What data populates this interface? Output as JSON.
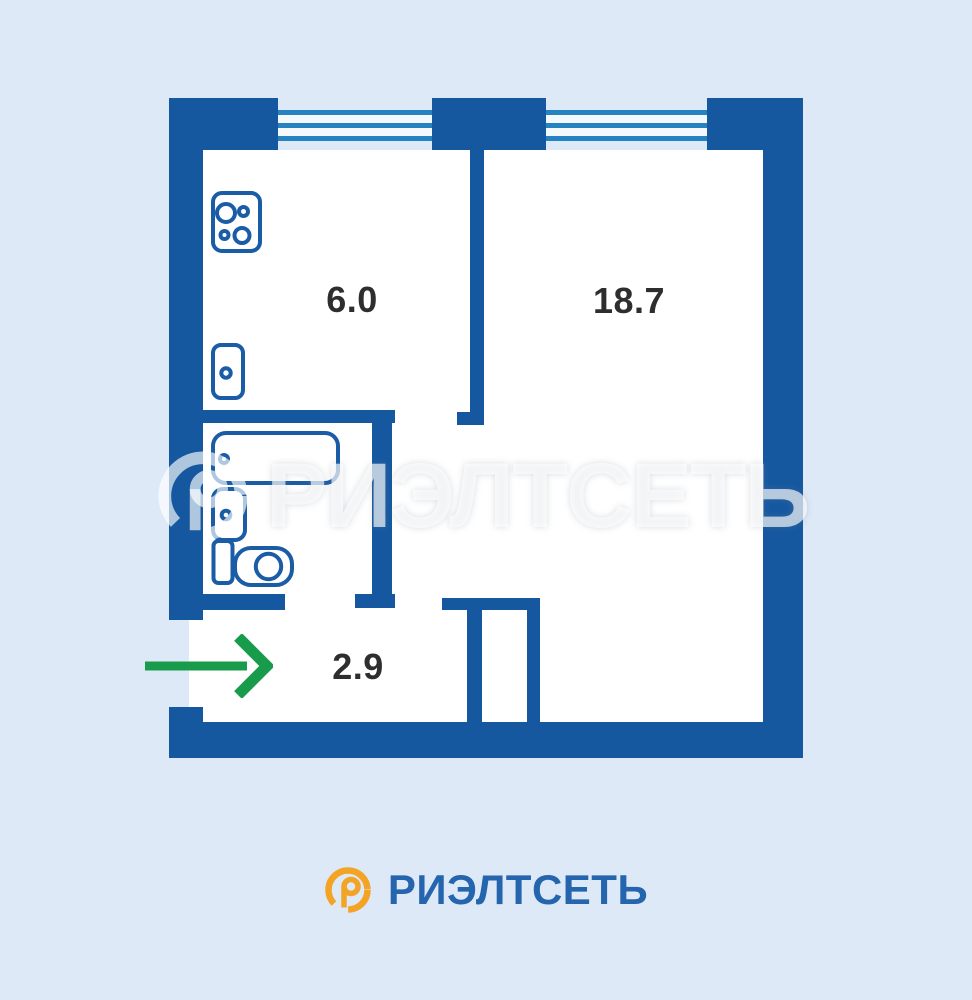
{
  "background": "#dee9f7",
  "floorplan": {
    "wall_color": "#1658a0",
    "fixture_outline_color": "#1a5ca6",
    "window_line_color": "#2583c1",
    "label_color": "#2e2e2e",
    "rooms": {
      "kitchen": {
        "label": "6.0"
      },
      "living": {
        "label": "18.7"
      },
      "hallway": {
        "label": "2.9"
      }
    },
    "fixtures": [
      "stove-icon",
      "kitchen-sink-icon",
      "bathtub-icon",
      "washbasin-icon",
      "toilet-icon"
    ],
    "entrance": {
      "arrow_color": "#189b4a"
    }
  },
  "watermark": {
    "text": "РИЭЛТСЕТЬ"
  },
  "logo": {
    "text": "РИЭЛТСЕТЬ",
    "text_color": "#2565ae",
    "icon_color": "#f3a425"
  }
}
